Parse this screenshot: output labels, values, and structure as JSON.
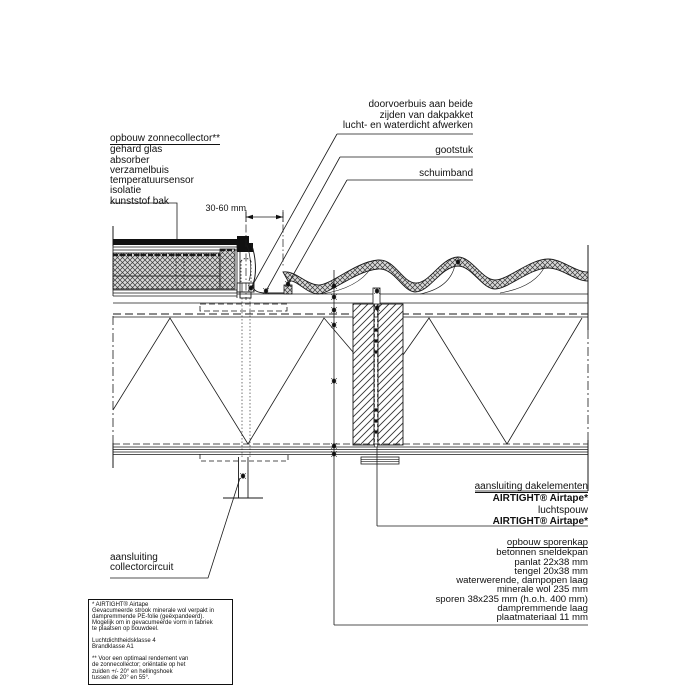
{
  "page": {
    "background": "#ffffff",
    "line_color": "#1a1a1a"
  },
  "collector": {
    "title": "opbouw zonnecollector**",
    "items": [
      "gehard glas",
      "absorber",
      "verzamelbuis",
      "temperatuursensor",
      "isolatie",
      "kunststof bak"
    ]
  },
  "top_right": {
    "doorvoerbuis_lines": [
      "doorvoerbuis aan beide",
      "zijden van dakpakket",
      "lucht- en waterdicht afwerken"
    ],
    "gootstuk": "gootstuk",
    "schuimband": "schuimband"
  },
  "dimension": {
    "label": "30-60 mm"
  },
  "junction": {
    "title": "aansluiting dakelementen",
    "airtape_top": "AIRTIGHT® Airtape*",
    "luchtspouw": "luchtspouw",
    "airtape_bottom": "AIRTIGHT® Airtape*"
  },
  "sporenkap": {
    "title": "opbouw sporenkap",
    "items": [
      "betonnen sneldekpan",
      "panlat 22x38 mm",
      "tengel 20x38 mm",
      "waterwerende, dampopen laag",
      "minerale wol 235 mm",
      "sporen 38x235 mm (h.o.h. 400 mm)",
      "dampremmende laag",
      "plaatmateriaal 11 mm"
    ]
  },
  "collectorcircuit": {
    "lines": [
      "aansluiting",
      "collectorcircuit"
    ]
  },
  "footnote": {
    "lines": [
      "* AIRTIGHT® Airtape",
      "Gevacumeerde strook minerale wol verpakt in",
      "dampremmende PE-folie (geëxpandeerd).",
      "Mogelijk om in gevacumeerde vorm in fabriek",
      "te plaatsen op bouwdeel.",
      "",
      "Luchtdichtheidsklasse 4",
      "Brandklasse A1",
      "",
      "** Voor een optimaal rendement van",
      "de zonnecollector; oriëntatie op het",
      "zuiden +/- 20° en hellingshoek",
      "tussen de 20° en 55°."
    ]
  }
}
